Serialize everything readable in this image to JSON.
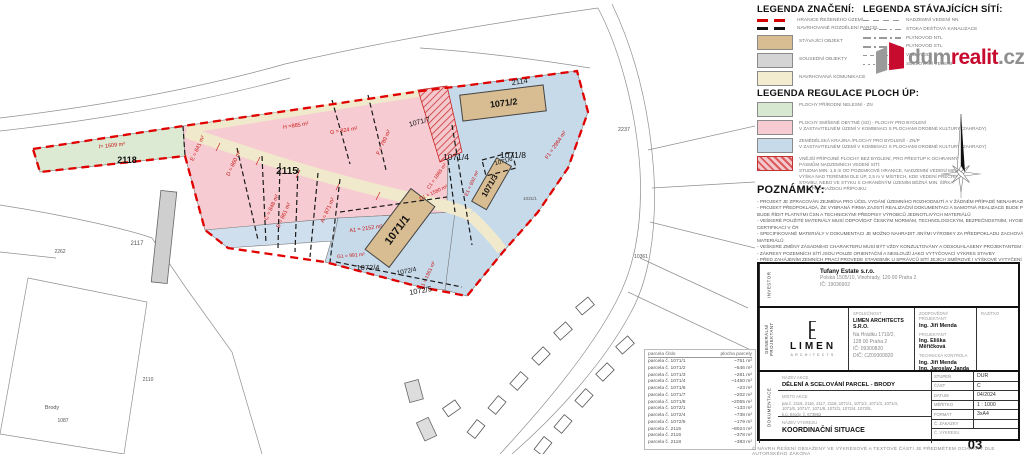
{
  "brand": {
    "dum": "dum",
    "realit": "realit",
    "cz": ".cz"
  },
  "legend_znaceni": {
    "title": "LEGENDA ZNAČENÍ:",
    "items": [
      {
        "swatch": "sw-lred",
        "kind": "leg-line",
        "label": "HRANICE ŘEŠENÉHO ÚZEMÍ"
      },
      {
        "swatch": "sw-lblk",
        "kind": "leg-line",
        "label": "NAVRHOVANÉ ROZDĚLENÍ PARCEL"
      },
      {
        "swatch": "sw-tan",
        "kind": "leg-swatch",
        "label": "STÁVAJÍCÍ OBJEKT"
      },
      {
        "swatch": "sw-gray",
        "kind": "leg-swatch",
        "label": "SOUSEDNÍ OBJEKTY"
      },
      {
        "swatch": "sw-cream",
        "kind": "leg-swatch",
        "label": "NAVRHOVANÁ KOMUNIKACE"
      }
    ]
  },
  "legend_siti": {
    "title": "LEGENDA STÁVAJÍCÍCH SÍTÍ:",
    "items": [
      {
        "swatch": "sw-d1",
        "label": "NADZEMNÍ VEDENÍ NN"
      },
      {
        "swatch": "sw-d3",
        "label": "STOKA DEŠŤOVÁ KANALIZACE"
      },
      {
        "swatch": "sw-d3",
        "label": "PLYNOVOD NTL"
      },
      {
        "swatch": "sw-d3",
        "label": "PLYNOVOD STL"
      },
      {
        "swatch": "sw-d4",
        "label": "VODOVOD"
      },
      {
        "swatch": "sw-d2",
        "label": "SDĚLOVACÍ VEDENÍ"
      }
    ]
  },
  "legend_regulace": {
    "title": "LEGENDA REGULACE PLOCH ÚP:",
    "items": [
      {
        "swatch": "sw-green",
        "text": "PLOCHY PŘÍRODNÍ NELESNÍ - ZN"
      },
      {
        "swatch": "sw-pink",
        "text": "PLOCHY SMÍŠENÉ OBYTNÉ (SO) - PLOCHY PRO BYDLENÍ\nV ZASTAVITELNÉM ÚZEMÍ V KOMBINACI S PLOCHAMI DROBNÉ KULTURY (ZAHRADY)"
      },
      {
        "swatch": "sw-blue",
        "text": "ZEMĚDĚLSKÁ KRAJINA /PLOCHY PRO BYDLENÍ/ - ZN/P\nV ZASTAVITELNÉM ÚZEMÍ V KOMBINACI S PLOCHAMI DROBNÉ KULTURY (ZAHRADY)"
      },
      {
        "swatch": "sw-hatch",
        "text": "VNĚJŠÍ PŘÍPOJNÉ PLOCHY BEZ BYDLENÍ, PRO PŘESTUP K OCHRANNÝM\nPÁSMŮM NADZEMNÍCH VEDENÍ SÍTÍ:\nSTUDNA MIN. 1,5 m OD POZEMKOVÉ HRANICE, NADZEMNÍ VEDENÍ MIN.\nVÝŠKA NAD TERÉNEM DLE ÚP, 2,5 m V MÍSTECH, KDE VEDENÍ PŘECHÁZÍ\nSTAVBU, NEBO VE STYKU S CHRÁNĚNÝM ÚZEMÍM BĚŽNÁ MIN. ŠÍŘKA\n1,5 m PRO KAŽDOU PŘÍPOJKU"
      }
    ]
  },
  "poznamky": {
    "title": "POZNÁMKY:",
    "lines": [
      "- PROJEKT JE ZPRACOVÁN ZEJMÉNA PRO ÚČEL VYDÁNÍ ÚZEMNÍHO ROZHODNUTÍ A V ŽÁDNÉM PŘÍPADĚ NENAHRAZUJE DOKUMENTACI PRO REALIZACI STAVBY",
      "- PROJEKT PŘEDPOKLÁDÁ, ŽE VYBRANÁ FIRMA ZAJISTÍ REALIZAČNÍ DOKUMENTACI A SAMOTNÁ REALIZACE BUDE PROVEDENA AUTORIZOVANOU FIRMOU, KTERÁ SE",
      "  BUDE ŘÍDIT PLATNÝMI ČSN A TECHNICKÝMI PŘEDPISY VÝROBCŮ JEDNOTLIVÝCH MATERIÁLŮ",
      "- VEŠKERÉ POUŽITÉ MATERIÁLY MUSÍ ODPOVÍDAT ČESKÝM NORMÁM, TECHNOLOGICKÝM, BEZPEČNOSTNÍM, HYGIENICKÝM A POŽÁRNÍM PŘEDPISŮM A MUSÍ MÍT",
      "  CERTIFIKACI V ČR",
      "- SPECIFIKOVANÉ MATERIÁLY V DOKUMENTACI JE MOŽNO NAHRADIT JINÝMI VÝROBKY ZA PŘEDPOKLADU ZACHOVÁNÍ TECHNICKÝCH PARAMETRŮ NAVRŽENÝCH",
      "  MATERIÁLŮ",
      "- VEŠKERÉ ZMĚNY ZÁSADNÍHO CHARAKTERU MUSÍ BÝT VŽDY KONZULTOVÁNY A ODSOUHLASENY PROJEKTANTEM NEBO ARCHITEKTEM",
      "- ZÁKRESY POZEMNÍCH SÍTÍ JSOU POUZE ORIENTAČNÍ A NESLOUŽÍ JAKO VYTYČOVACÍ VÝKRES STAVBY",
      "- PŘED ZAHÁJENÍM ZEMNÍCH PRACÍ PROVEDE STAVEBNÍK U SPRÁVCŮ SÍTÍ JEJICH SMĚROVÉ I VÝŠKOVÉ VYTYČENÍ",
      "- BUDE DODRŽENA ČSN 73 6005 PROSTOROVÉ USPOŘÁDÁNÍ SÍTÍ TECHNICKÉHO VYBAVENÍ",
      "- BUDOU DODRŽENY PODMÍNKY VŠECH SPRÁVCŮ SÍTÍ KE VZDÁLENOSTEM DLE ČSN 73"
    ]
  },
  "map": {
    "labels": {
      "p2114": "2114",
      "p2115": "2115",
      "p2117": "2117",
      "p2118": "2118",
      "i1": "I= 1609 m²",
      "hA": "H =865 m²",
      "gA": "G = 824 m²",
      "fA": "F = 780 m²",
      "eA": "E = 841 m²",
      "dA": "D = 860 m²",
      "cA": "C = 848 m²",
      "bA": "B = 861 m²",
      "aA": "A = 871 m²",
      "a1": "A1 = 2152 m²",
      "b1": "B1 = 1361 m²",
      "c1": "C1 = 1665 m²",
      "d1": "D1 = 1580 m²",
      "e1": "E1 = 932 m²",
      "f1": "F1 = 2964 m²",
      "g1": "G1 = 991 m²",
      "p1071_1": "1071/1",
      "p1071_2": "1071/2",
      "p1071_3": "1071/3",
      "p1071_4": "1071/4",
      "p1071_6": "1071/6",
      "p1071_7": "1071/7",
      "p1071_8": "1071/8",
      "p1072_4a": "1072/4",
      "p1072_4b": "1072/4",
      "p1072_5": "1072/5",
      "n2237": "2237",
      "n2262": "2262",
      "n10361": "10361",
      "n1087": "1087",
      "nbrody": "Brody",
      "n2110": "2110",
      "n1031": "1031/1"
    }
  },
  "parcel_table": {
    "col1": "parcela číslo",
    "col2": "plocha parcely",
    "rows": [
      {
        "c": "parcela č. 1071/1",
        "a": "~751 m²"
      },
      {
        "c": "parcela č. 1071/2",
        "a": "~546 m²"
      },
      {
        "c": "parcela č. 1071/3",
        "a": "~281 m²"
      },
      {
        "c": "parcela č. 1071/4",
        "a": "~1450 m²"
      },
      {
        "c": "parcela č. 1071/6",
        "a": "~23 m²"
      },
      {
        "c": "parcela č. 1071/7",
        "a": "~202 m²"
      },
      {
        "c": "parcela č. 1071/8",
        "a": "~2055 m²"
      },
      {
        "c": "parcela č. 1072/1",
        "a": "~133 m²"
      },
      {
        "c": "parcela č. 1072/4",
        "a": "~738 m²"
      },
      {
        "c": "parcela č. 1072/5",
        "a": "~179 m²"
      },
      {
        "c": "parcela č. 2115",
        "a": "~8024 m²"
      },
      {
        "c": "parcela č. 2116",
        "a": "~378 m²"
      },
      {
        "c": "parcela č. 2118",
        "a": "~383 m²"
      }
    ]
  },
  "titleblock": {
    "investor_label": "INVESTOR",
    "gp_label": "GENERÁLNÍ PROJEKTANT",
    "dok_label": "DOKUMENTACE",
    "investor_name": "Tufany Estate s.r.o.",
    "investor_addr": "Polská 1505/10, Vinohrady, 120 00 Praha 2",
    "investor_ic": "IČ: 19036902",
    "logo_name": "LIMEN",
    "logo_sub": "ARCHITECTS",
    "company_label": "SPOLEČNOST",
    "company_name": "LIMEN ARCHITECTS S.R.O.",
    "company_addr": "Na Hrádku 1710/2,\n128 00 Praha 2\nIČ: 09300820\nDIČ: CZ09300820",
    "resp_label": "ZODPOVĚDNÝ PROJEKTANT",
    "resp_name": "Ing. Jiří Menda",
    "proj_label": "PROJEKTANT",
    "proj_name": "Ing. Eliška Měřičková",
    "tech_label": "TECHNICKÁ KONTROLA",
    "tech_name1": "Ing. Jiří Menda",
    "tech_name2": "Ing. Jaroslav Janda",
    "razitko_label": "RAZÍTKO",
    "akce_label": "NÁZEV AKCE",
    "akce": "DĚLENÍ A SCELOVÁNÍ PARCEL - BRODY",
    "misto_label": "MÍSTO AKCE",
    "misto": "par.č. 2115, 2116, 2117, 2118, 1071/1, 1071/2, 1071/3, 1071/4,\n1071/6, 1071/7, 1071/8, 1072/1, 1072/4, 1072/5,\nk.ú. Brody, č. 673862",
    "vykres_label": "NÁZEV VÝKRESU",
    "vykres": "KOORDINAČNÍ SITUACE",
    "fields": [
      {
        "label": "STUPEŇ",
        "value": "DUR"
      },
      {
        "label": "ČÁST",
        "value": "C"
      },
      {
        "label": "DATUM",
        "value": "04/2024"
      },
      {
        "label": "MĚŘÍTKO",
        "value": "1 : 1000"
      },
      {
        "label": "FORMÁT",
        "value": "3xA4"
      },
      {
        "label": "Č. ZAKÁZKY",
        "value": ""
      }
    ],
    "cislo_label": "Č. VÝKRESU",
    "cislo": "03"
  },
  "copyright": "© NÁVRH ŘEŠENÍ OBSAŽENÝ VE VÝKRESOVÉ A TEXTOVÉ ČÁSTI JE PŘEDMĚTEM OCHRANY DLE AUTORSKÉHO ZÁKONA"
}
